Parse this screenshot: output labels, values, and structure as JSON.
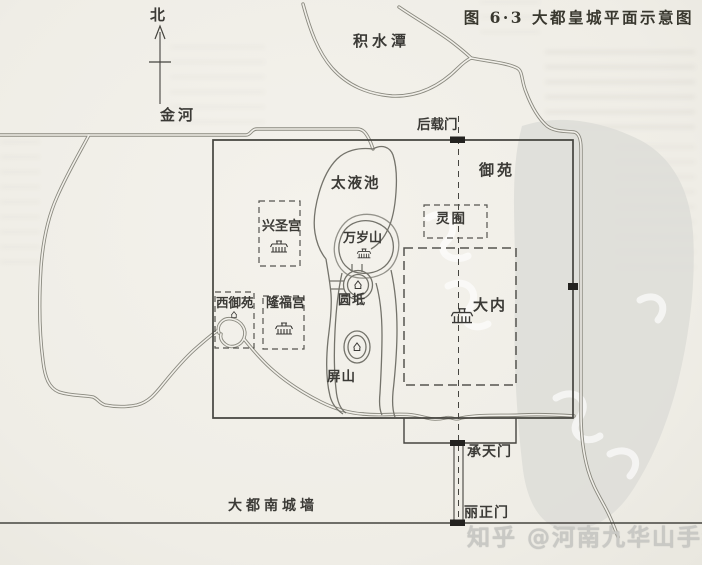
{
  "figure": {
    "title": "图 6·3 大都皇城平面示意图"
  },
  "compass": {
    "north_label": "北"
  },
  "water": {
    "jishuitan_label": "积水潭",
    "jinhe_label": "金河",
    "taiyechi_label": "太液池"
  },
  "gates": {
    "houzaimen_label": "后载门",
    "chengtianmen_label": "承天门",
    "lizhengmen_label": "丽正门"
  },
  "areas": {
    "yuyuan_label": "御苑",
    "lingyou_label": "灵囿",
    "danei_label": "大内",
    "xingshenggong_label": "兴圣宫",
    "longfugong_label": "隆福宫",
    "xiyuyuan_label": "西御苑",
    "wansuishan_label": "万岁山",
    "yuandi_label": "圆坻",
    "pingshan_label": "屏山"
  },
  "walls": {
    "south_wall_label": "大都南城墙"
  },
  "watermark": {
    "credit": "知乎 @河南九华山手绘"
  },
  "colors": {
    "paper": "#f1efe9",
    "ink": "#3b3a36",
    "water_line": "#84837c",
    "wall_line": "#45443f",
    "watermark_text": "#c9c9c5",
    "watermark_blob": "#dcdcd7"
  }
}
